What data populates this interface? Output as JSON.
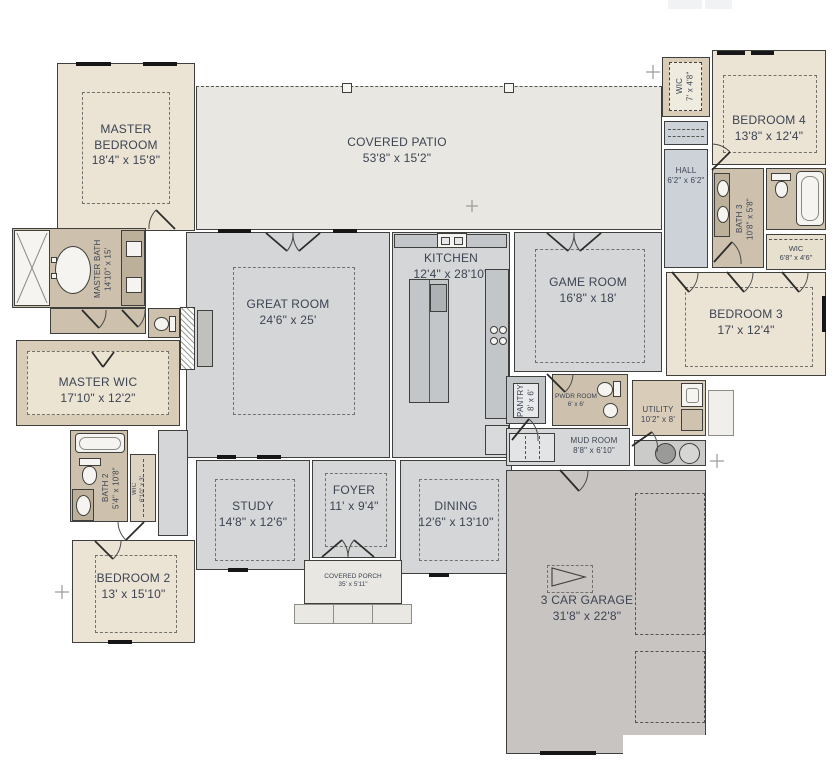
{
  "title": "Single-story house floor plan",
  "rooms": {
    "master_bedroom": {
      "name": "MASTER BEDROOM",
      "dims": "18'4\" x 15'8\""
    },
    "covered_patio": {
      "name": "COVERED PATIO",
      "dims": "53'8\" x 15'2\""
    },
    "great_room": {
      "name": "GREAT ROOM",
      "dims": "24'6\" x 25'"
    },
    "kitchen": {
      "name": "KITCHEN",
      "dims": "12'4\" x 28'10\""
    },
    "game_room": {
      "name": "GAME ROOM",
      "dims": "16'8\" x 18'"
    },
    "wic_bedroom4": {
      "name": "WIC",
      "dims": "7' x 4'8\""
    },
    "bedroom4": {
      "name": "BEDROOM 4",
      "dims": "13'8\" x 12'4\""
    },
    "hall": {
      "name": "HALL",
      "dims": "6'2\" x 6'2\""
    },
    "bath3": {
      "name": "BATH 3",
      "dims": "10'8\" x 5'8\""
    },
    "wic_bedroom3": {
      "name": "WIC",
      "dims": "6'8\" x 4'6\""
    },
    "bedroom3": {
      "name": "BEDROOM 3",
      "dims": "17' x 12'4\""
    },
    "master_bath": {
      "name": "MASTER BATH",
      "dims": "14'10\" x 15'"
    },
    "master_wic": {
      "name": "MASTER WIC",
      "dims": "17'10\" x 12'2\""
    },
    "pantry": {
      "name": "PANTRY",
      "dims": "8' x 6'"
    },
    "powder_room": {
      "name": "PWDR ROOM",
      "dims": "6' x 6'"
    },
    "utility": {
      "name": "UTILITY",
      "dims": "10'2\" x 8'"
    },
    "mud_room": {
      "name": "MUD ROOM",
      "dims": "8'8\" x 6'10\""
    },
    "bath2": {
      "name": "BATH 2",
      "dims": "5'4\" x 10'8\""
    },
    "wic_bedroom2": {
      "name": "WIC",
      "dims": "6'10\" x 3'"
    },
    "bedroom2": {
      "name": "BEDROOM 2",
      "dims": "13' x 15'10\""
    },
    "study": {
      "name": "STUDY",
      "dims": "14'8\" x 12'6\""
    },
    "foyer": {
      "name": "FOYER",
      "dims": "11' x 9'4\""
    },
    "dining": {
      "name": "DINING",
      "dims": "12'6\" x 13'10\""
    },
    "covered_porch": {
      "name": "COVERED PORCH",
      "dims": "35' x 5'11\""
    },
    "garage": {
      "name": "3 CAR GARAGE",
      "dims": "31'8\" x 22'8\""
    }
  },
  "palette": {
    "room_beige": "#ebe3d3",
    "room_gray": "#d4d6d7",
    "room_taupe": "#cdc1ad",
    "patio": "#e9e7e1",
    "hall_blue": "#ccd2d8",
    "utility_tan": "#d9cdb9",
    "garage": "#c8c4c1",
    "wall": "#3f3f3d",
    "label": "#3c4453",
    "counter": "#bcb09a",
    "band": "#d9cdb8"
  }
}
